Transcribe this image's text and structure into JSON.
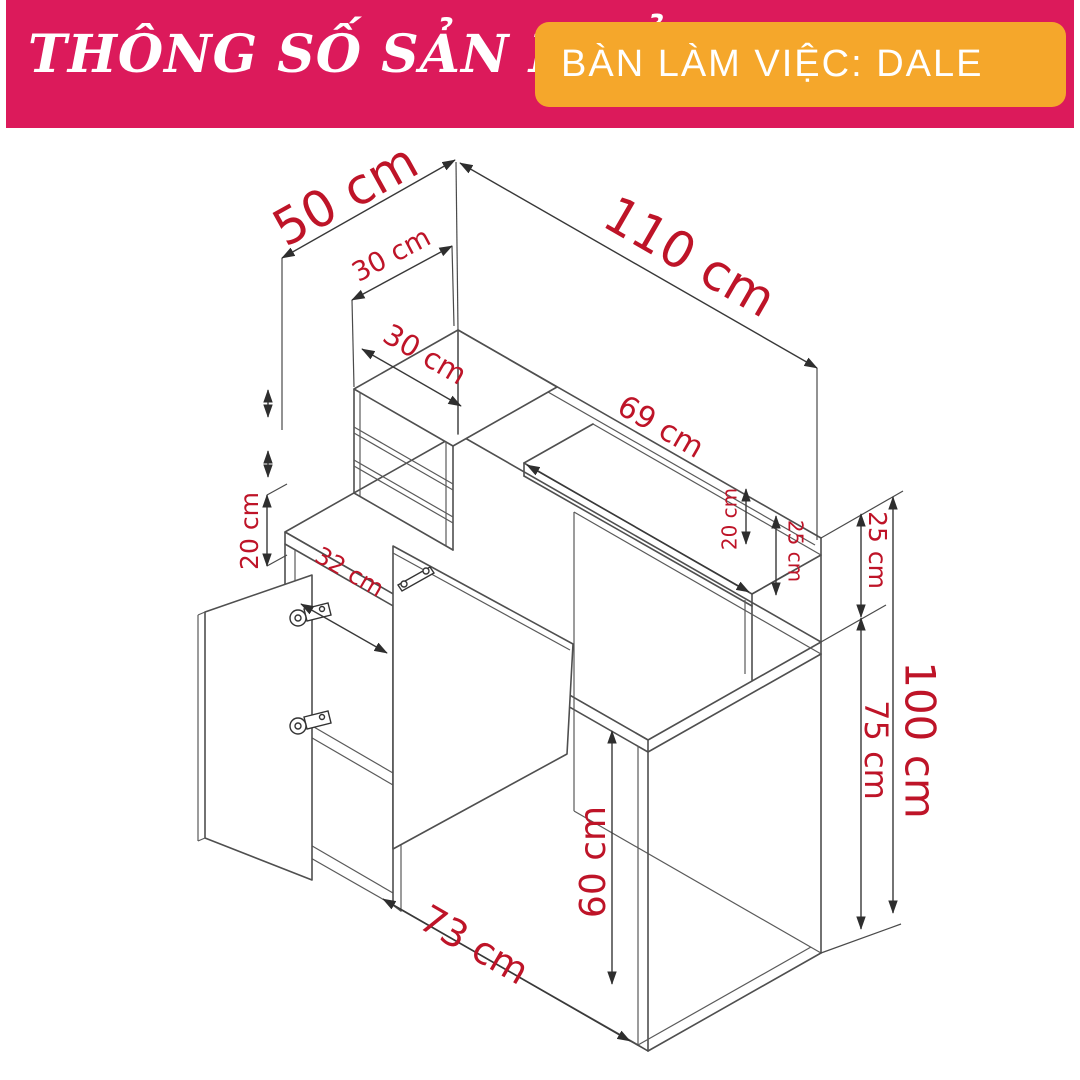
{
  "header": {
    "title": "THÔNG SỐ SẢN PHẨM",
    "product_badge": "BÀN LÀM VIỆC: DALE"
  },
  "colors": {
    "header_band": "#DC1A5B",
    "badge": "#F5A72B",
    "dimension_text": "#BE1428",
    "drawing_line": "#4F4F4F",
    "background": "#FFFFFF"
  },
  "diagram": {
    "type": "furniture-dimension-drawing",
    "product": "Bàn làm việc DALE",
    "dims": [
      {
        "id": "desk-depth-top",
        "label": "50 cm"
      },
      {
        "id": "desk-width-total",
        "label": "110 cm"
      },
      {
        "id": "hutch-depth",
        "label": "30 cm"
      },
      {
        "id": "hutch-width",
        "label": "30 cm"
      },
      {
        "id": "shelf-length",
        "label": "69 cm"
      },
      {
        "id": "left-gap-height",
        "label": "20 cm"
      },
      {
        "id": "cabinet-width",
        "label": "32 cm"
      },
      {
        "id": "right-gap-height",
        "label": "20 cm"
      },
      {
        "id": "shelf-rise",
        "label": "25 cm"
      },
      {
        "id": "hutch-rise",
        "label": "25 cm"
      },
      {
        "id": "desktop-height",
        "label": "75 cm"
      },
      {
        "id": "total-height",
        "label": "100 cm"
      },
      {
        "id": "knee-space-height",
        "label": "60 cm"
      },
      {
        "id": "knee-space-width",
        "label": "73 cm"
      }
    ]
  }
}
